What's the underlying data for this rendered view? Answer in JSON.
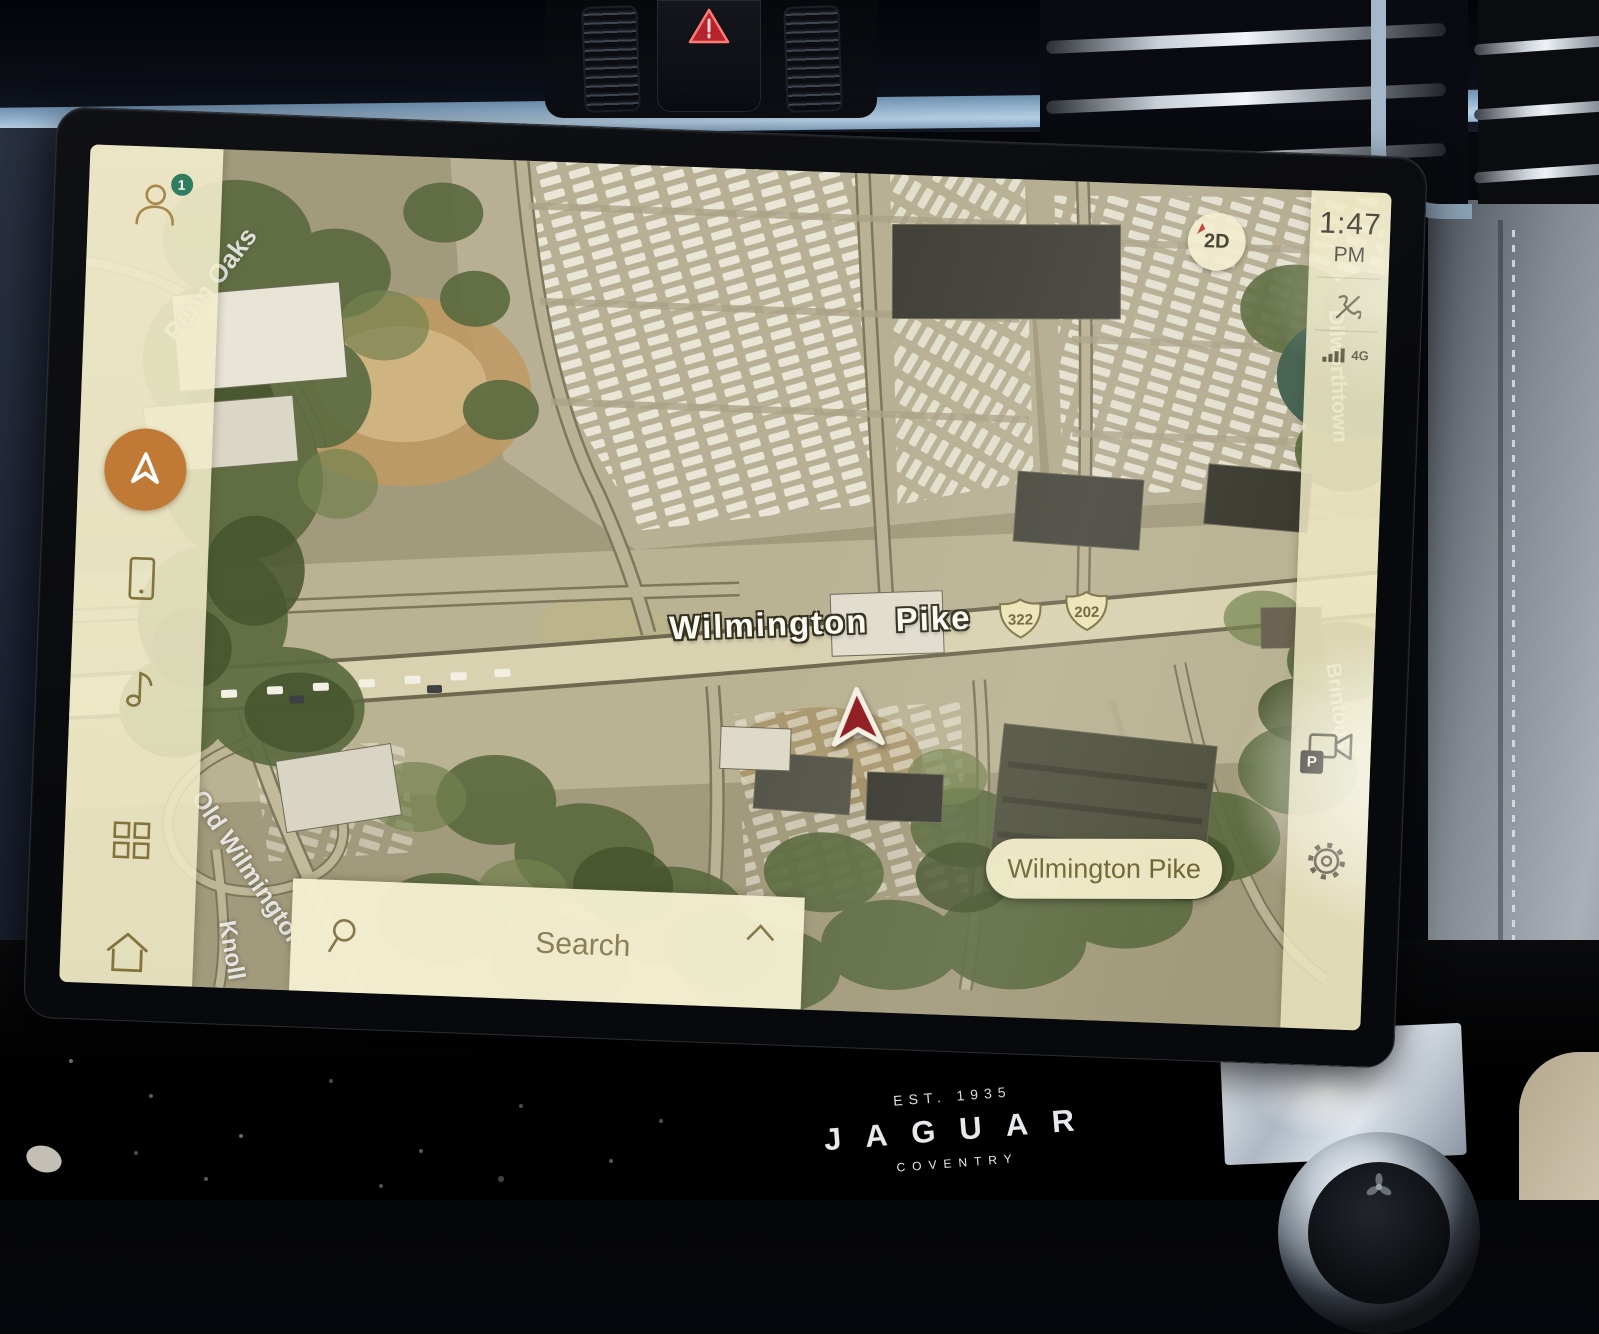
{
  "status": {
    "time": "1:47",
    "meridiem": "PM",
    "network": "4G"
  },
  "sidebar": {
    "notification_count": "1"
  },
  "map_controls": {
    "mode": "2D"
  },
  "search": {
    "placeholder": "Search"
  },
  "map": {
    "primary_road": "Wilmington Pike",
    "current_street": "Wilmington Pike",
    "shields": [
      "322",
      "202"
    ],
    "streets": [
      "Penn Oaks",
      "Old Wilmington",
      "Knoll",
      "Dilworthtown",
      "Brintons"
    ]
  },
  "right_panel": {
    "parking_badge": "P"
  },
  "branding": {
    "established": "EST. 1935",
    "make": "JAGUAR",
    "city": "COVENTRY"
  },
  "colors": {
    "accent_orange": "#c07a36",
    "badge_green": "#2f7d5e",
    "marker_red": "#8f1a1f",
    "panel_cream": "#f0ebc9"
  }
}
